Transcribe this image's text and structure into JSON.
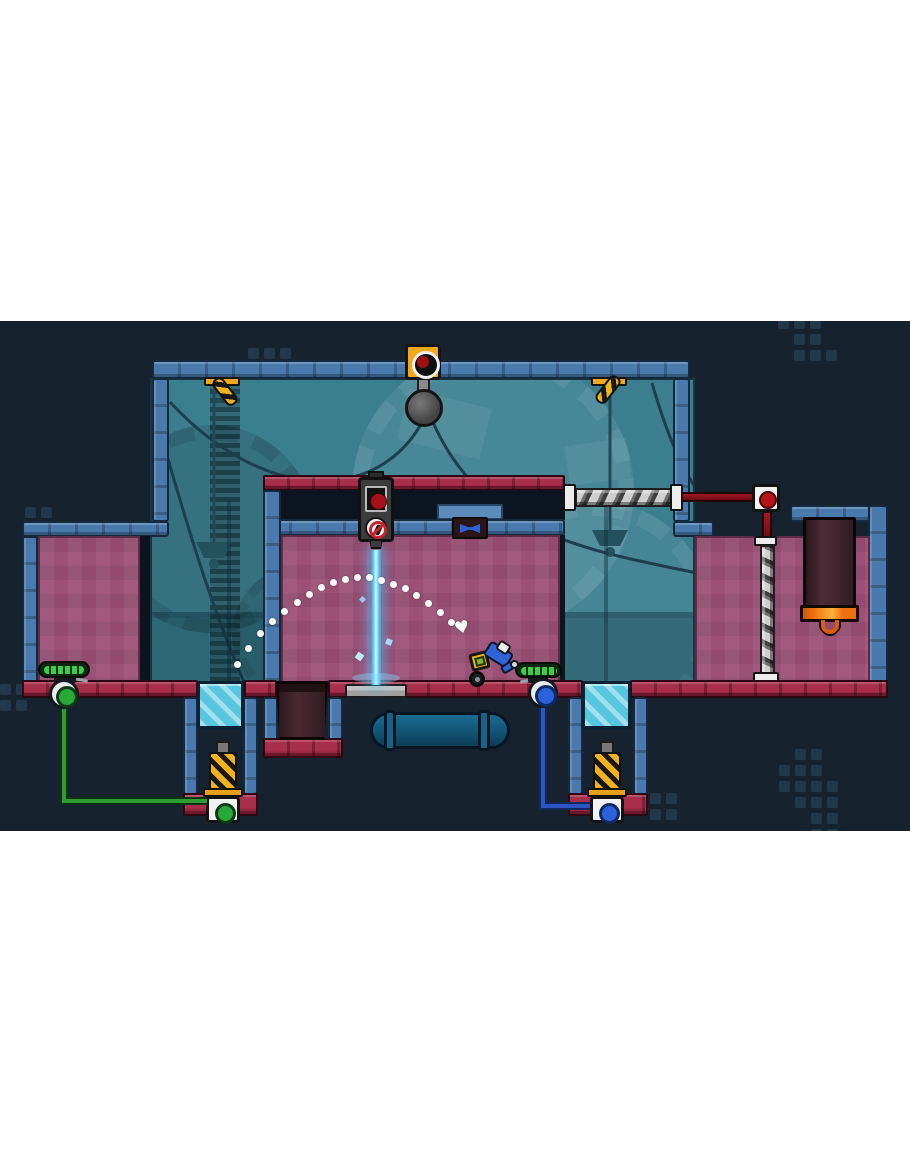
{
  "window": {
    "kind": "game-screenshot",
    "letterbox_color": "#ffffff"
  },
  "colors": {
    "white": "#ffffff",
    "navy": "#16222e",
    "blue": "#4a7aad",
    "blueLight": "#5d8cbb",
    "crimson": "#98253f",
    "crimsonBrick": "#a72f4c",
    "pink": "#9b5076",
    "glass": "#3b7e8e",
    "cyanPanel": "#57c6df",
    "laser": "#49c8f2",
    "laserCore": "#d6f4ff",
    "yellow": "#f0a81c",
    "green": "#35c33f",
    "greenWire": "#2d9c33",
    "greenDeep": "#0c3a14",
    "blueBtn": "#2b62d9",
    "blueWire": "#2b55c0",
    "redLamp": "#a8121a",
    "orange": "#ee7110",
    "orangeLight": "#ffb13c",
    "pipe": "#14587a",
    "barrel": "#38222a",
    "metal": "#b9b9b9"
  },
  "icons": {
    "heart_marker": "♥",
    "red_lamp": "filled-circle",
    "no_entry_sign": "prohibition-circle-with-slash",
    "hazard_bracket": "diagonal-stripes",
    "bowtie_item": "bowtie-shape"
  },
  "trajectory": {
    "marker_glyph": "♥",
    "dots": [
      [
        237,
        343
      ],
      [
        248,
        327
      ],
      [
        260,
        312
      ],
      [
        272,
        300
      ],
      [
        284,
        290
      ],
      [
        297,
        281
      ],
      [
        309,
        273
      ],
      [
        321,
        266
      ],
      [
        333,
        261
      ],
      [
        345,
        258
      ],
      [
        357,
        256
      ],
      [
        369,
        256
      ],
      [
        381,
        259
      ],
      [
        393,
        263
      ],
      [
        405,
        267
      ],
      [
        416,
        274
      ],
      [
        428,
        282
      ],
      [
        440,
        291
      ],
      [
        451,
        301
      ]
    ],
    "marker_pos": [
      456,
      302
    ]
  },
  "background": {
    "dot_pitch": 16,
    "dot_size": 11,
    "dot_clusters": [
      {
        "x": 248,
        "y": 27,
        "cells": [
          [
            0,
            0
          ],
          [
            1,
            0
          ],
          [
            2,
            0
          ]
        ]
      },
      {
        "x": 778,
        "y": -3,
        "cells": [
          [
            0,
            0
          ],
          [
            1,
            0
          ],
          [
            2,
            0
          ],
          [
            1,
            1
          ],
          [
            2,
            1
          ],
          [
            1,
            2
          ],
          [
            2,
            2
          ],
          [
            3,
            2
          ]
        ]
      },
      {
        "x": 25,
        "y": 186,
        "cells": [
          [
            0,
            0
          ],
          [
            1,
            0
          ]
        ]
      },
      {
        "x": 0,
        "y": 363,
        "cells": [
          [
            0,
            0
          ],
          [
            1,
            0
          ],
          [
            0,
            1
          ],
          [
            1,
            1
          ]
        ]
      },
      {
        "x": 779,
        "y": 428,
        "cells": [
          [
            1,
            0
          ],
          [
            2,
            0
          ],
          [
            0,
            1
          ],
          [
            1,
            1
          ],
          [
            2,
            1
          ],
          [
            0,
            2
          ],
          [
            1,
            2
          ],
          [
            2,
            2
          ],
          [
            3,
            2
          ],
          [
            1,
            3
          ],
          [
            2,
            3
          ],
          [
            3,
            3
          ],
          [
            2,
            4
          ],
          [
            3,
            4
          ],
          [
            2,
            5
          ],
          [
            3,
            5
          ]
        ]
      },
      {
        "x": 650,
        "y": 472,
        "cells": [
          [
            0,
            0
          ],
          [
            1,
            0
          ],
          [
            0,
            1
          ],
          [
            1,
            1
          ]
        ]
      }
    ]
  }
}
